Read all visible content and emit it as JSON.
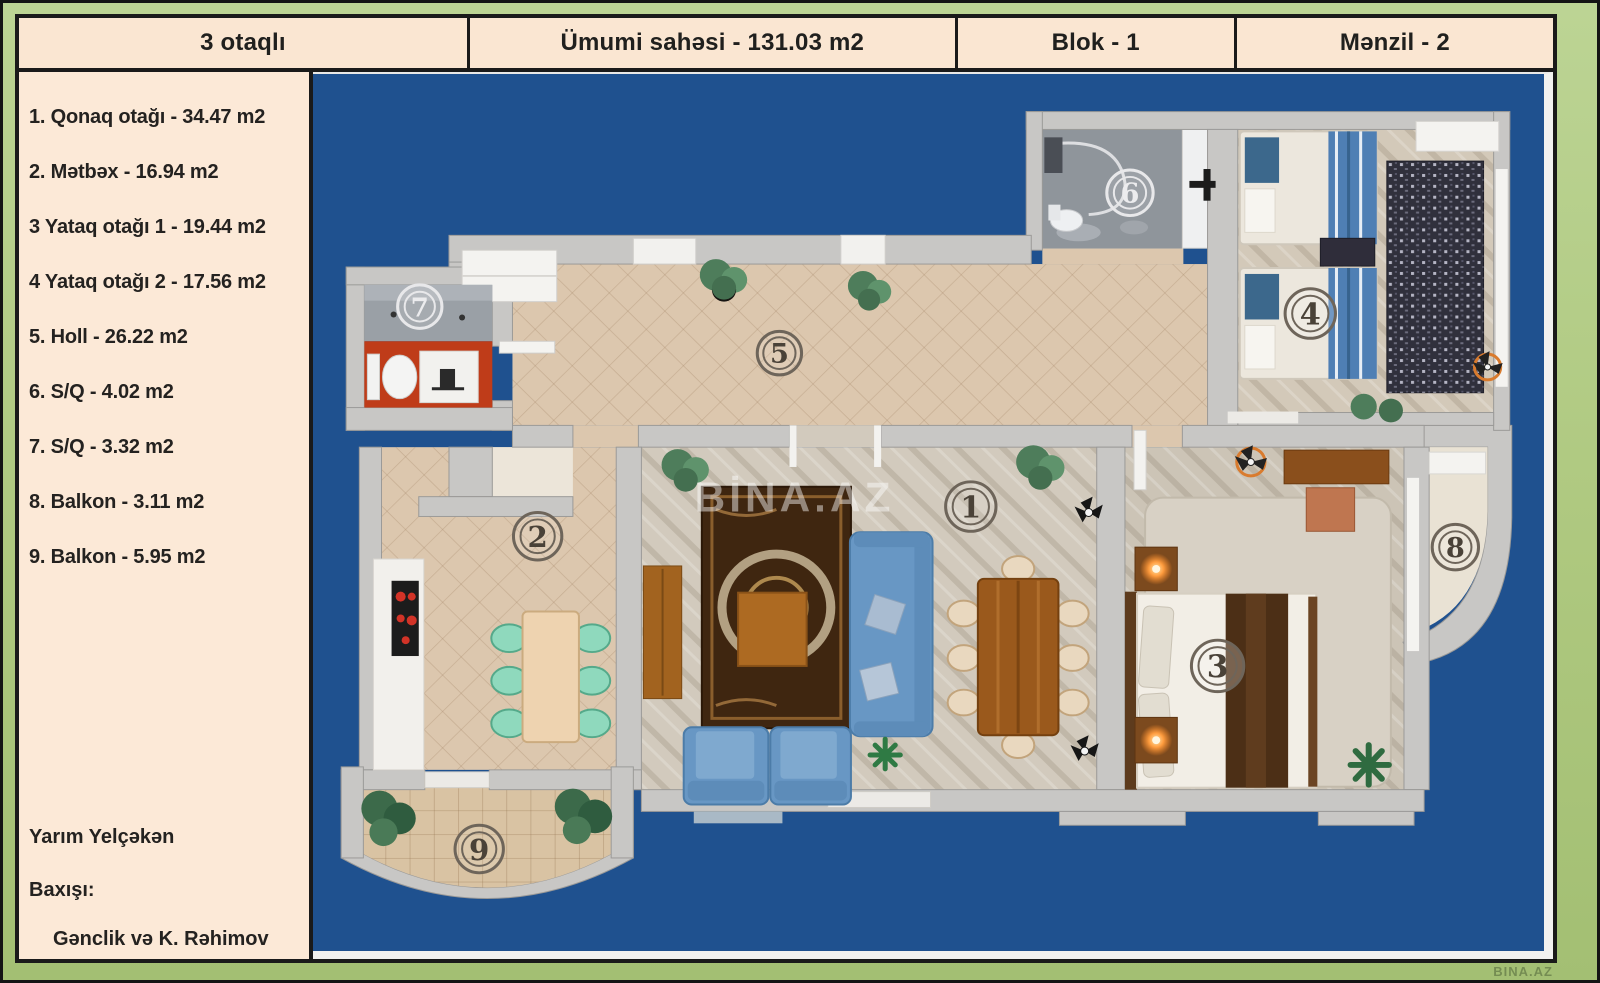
{
  "header": {
    "cells": [
      {
        "label": "3 otaqlı"
      },
      {
        "label": "Ümumi sahəsi - 131.03 m2"
      },
      {
        "label": "Blok - 1"
      },
      {
        "label": "Mənzil - 2"
      }
    ]
  },
  "sidebar": {
    "rooms": [
      {
        "label": "1. Qonaq otağı - 34.47 m2"
      },
      {
        "label": "2. Mətbəx - 16.94 m2"
      },
      {
        "label": "3 Yataq otağı 1 - 19.44 m2"
      },
      {
        "label": "4 Yataq otağı 2 - 17.56 m2"
      },
      {
        "label": "5. Holl - 26.22 m2"
      },
      {
        "label": "6. S/Q - 4.02 m2"
      },
      {
        "label": "7. S/Q - 3.32 m2"
      },
      {
        "label": "8. Balkon  - 3.11 m2"
      },
      {
        "label": "9. Balkon  - 5.95 m2"
      }
    ],
    "notes": [
      {
        "label": "Yarım Yelçəkən"
      },
      {
        "label": "Baxışı:"
      },
      {
        "label": "Gənclik və K. Rəhimov"
      }
    ]
  },
  "plan": {
    "watermark": "BİNA.AZ",
    "corner_watermark": "BINA.AZ",
    "room_labels": [
      {
        "number": "1"
      },
      {
        "number": "2"
      },
      {
        "number": "3"
      },
      {
        "number": "4"
      },
      {
        "number": "5"
      },
      {
        "number": "6"
      },
      {
        "number": "7"
      },
      {
        "number": "8"
      },
      {
        "number": "9"
      }
    ]
  },
  "colors": {
    "frame_green": "#aec87f",
    "panel_cream": "#fce9d7",
    "plan_blue": "#1f518f",
    "wall_gray": "#c8c7c5",
    "hall_beige": "#dcc7ae",
    "bath_red": "#bf3c19",
    "sofa_blue": "#6897c4",
    "kitchen_chair_teal": "#8fd9bd",
    "rug_brown": "#3f2610"
  }
}
